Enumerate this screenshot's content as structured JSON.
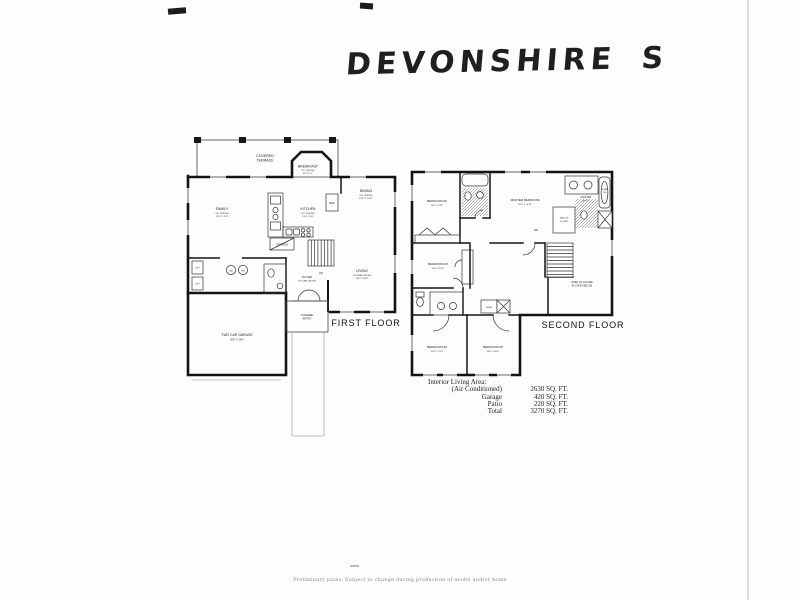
{
  "page": {
    "title": "DEVONSHIRE S",
    "first_floor_label": "FIRST FLOOR",
    "second_floor_label": "SECOND FLOOR",
    "disclaimer": "Preliminary plans: Subject to change during production of model and/or home"
  },
  "first_floor": {
    "terrace": {
      "line1": "COVERED",
      "line2": "TERRACE"
    },
    "breakfast": {
      "name": "BREAKFAST",
      "ceiling": "9'0\" CEILING",
      "dims": "9'8\" X 7'0\""
    },
    "dining": {
      "name": "DINING",
      "ceiling": "9'0\" CEILING",
      "dims": "12'4\" X 13'10\""
    },
    "family": {
      "name": "FAMILY",
      "ceiling": "9'0\" CEILING",
      "dims": "17'0\" X 15'0\""
    },
    "kitchen": {
      "name": "KITCHEN",
      "ceiling": "9'0\" CEILING",
      "dims": "13'4\" X 9'0\""
    },
    "living": {
      "name": "LIVING",
      "ceiling": "VOLUME CEILING",
      "dims": "14'0\" X 16'0\""
    },
    "foyer": {
      "name": "FOYER",
      "ceiling": "VOLUME CEILING"
    },
    "storage": "STORAGE",
    "covered_entry": {
      "line1": "COVERED",
      "line2": "ENTRY"
    },
    "garage": {
      "name": "TWO CAR GARAGE",
      "dims": "20'0\" X 19'4\""
    },
    "up": "UP",
    "ref": "REF",
    "washer": "WA",
    "dryer": "DR",
    "opt": "OPT"
  },
  "second_floor": {
    "bedroom2": {
      "name": "BEDROOM #2",
      "dims": "10'0\" X 13'0\""
    },
    "bedroom3": {
      "name": "BEDROOM #3",
      "dims": "11'0\" X 13'0\""
    },
    "bedroom4": {
      "name": "BEDROOM #4",
      "dims": "10'0\" X 11'0\""
    },
    "bedroom5": {
      "name": "BEDROOM #5",
      "dims": "10'0\" X 10'0\""
    },
    "master_bedroom": {
      "name": "MASTER BEDROOM",
      "dims": "16'0\" X 13'10\""
    },
    "master_bath": {
      "line1": "MASTER",
      "line2": "BATH"
    },
    "roman_tub": {
      "line1": "ROMAN",
      "line2": "TUB"
    },
    "walk_in_closet": {
      "line1": "WALK-IN",
      "line2": "CLOSET"
    },
    "linen": "LINEN",
    "open_to_volume": {
      "line1": "OPEN TO VOLUME",
      "line2": "IN LIVING BELOW"
    },
    "dn": "DN"
  },
  "area_table": {
    "title": "Interior Living Area:",
    "rows": [
      {
        "label": "(Air Conditioned)",
        "value": "2630 SQ. FT."
      },
      {
        "label": "Garage",
        "value": "420 SQ. FT."
      },
      {
        "label": "Patio",
        "value": "220 SQ. FT."
      },
      {
        "label": "Total",
        "value": "3270 SQ. FT."
      }
    ]
  }
}
